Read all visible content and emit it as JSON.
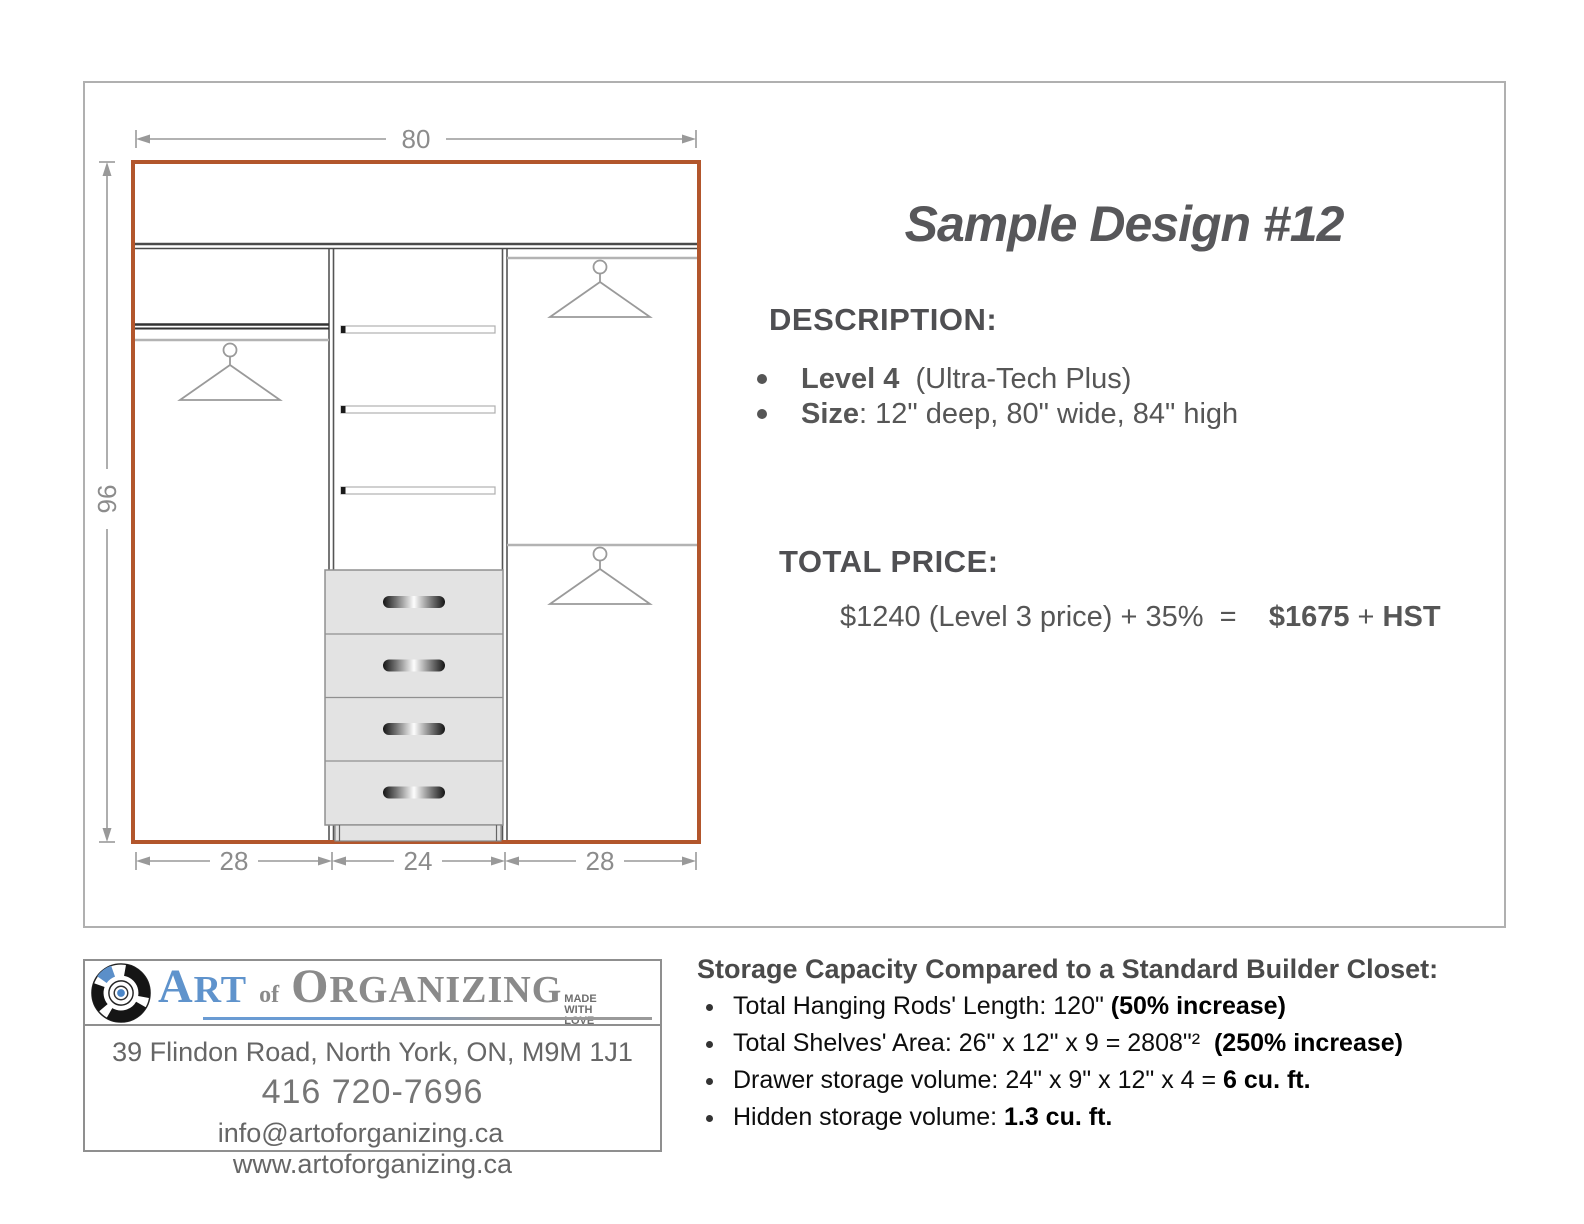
{
  "title": "Sample Design #12",
  "description": {
    "heading": "DESCRIPTION:",
    "items": [
      {
        "label": "Level 4",
        "text": "  (Ultra-Tech Plus)"
      },
      {
        "label": "Size",
        "text": ": 12\" deep, 80\" wide, 84\" high"
      }
    ]
  },
  "price": {
    "heading": "TOTAL PRICE:",
    "formula": "$1240 (Level 3 price) + 35%  =    ",
    "amount": "$1675",
    "separator": " + ",
    "tax": "HST"
  },
  "diagram": {
    "width_label": "80",
    "height_label": "96",
    "section_labels": [
      "28",
      "24",
      "28"
    ],
    "accent_color": "#b2562c"
  },
  "footer": {
    "logo": {
      "art_initial": "A",
      "art_rest": "RT",
      "of": "of",
      "org_initial": "O",
      "org_rest": "RGANIZING",
      "tagline_line1": "MADE",
      "tagline_line2": "WITH",
      "tagline_line3": "LOVE"
    },
    "address": {
      "line1": "39 Flindon Road, North York, ON, M9M 1J1",
      "phone": "416 720-7696",
      "email": "info@artoforganizing.ca",
      "website": "www.artoforganizing.ca"
    },
    "storage": {
      "heading": "Storage Capacity Compared to a Standard Builder Closet:",
      "items": [
        {
          "text": "Total Hanging Rods' Length: 120\" ",
          "bold": "(50% increase)"
        },
        {
          "text": "Total Shelves' Area: 26\" x 12\" x 9 = 2808\"²  ",
          "bold": "(250% increase)"
        },
        {
          "text": "Drawer storage volume: 24\" x 9\" x 12\" x 4 = ",
          "bold": "6 cu. ft."
        },
        {
          "text": "Hidden storage volume: ",
          "bold": "1.3 cu. ft."
        }
      ]
    }
  }
}
